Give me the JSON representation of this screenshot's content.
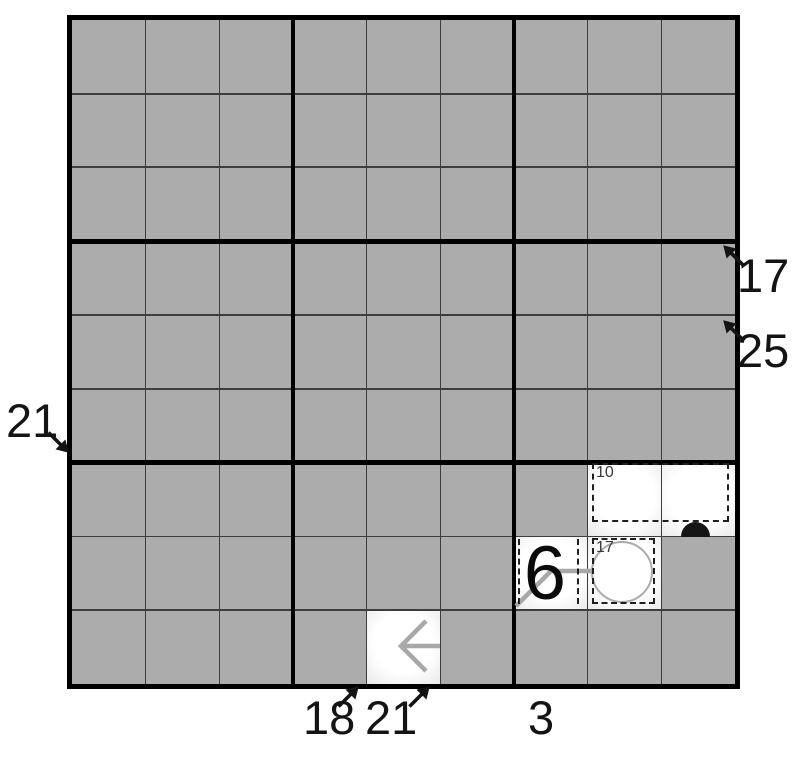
{
  "puzzle": {
    "kind": "sudoku-variant-grid",
    "grid": {
      "rows": 9,
      "cols": 9
    },
    "colors": {
      "cell_gray": "#acacac",
      "thin_line": "#3d3d3d",
      "box_line": "#000000",
      "clue_text": "#141414",
      "cage_dash": "#1f1f1f",
      "shape_gray": "#a8a8a8",
      "dot_black": "#151515"
    },
    "clues": [
      {
        "value": "17",
        "side": "right",
        "arrow": "up-left"
      },
      {
        "value": "25",
        "side": "right",
        "arrow": "up-left"
      },
      {
        "value": "21",
        "side": "left",
        "arrow": "down-right"
      },
      {
        "value": "18",
        "side": "bottom",
        "arrow": "up-right"
      },
      {
        "value": "21",
        "side": "bottom",
        "arrow": "up-right"
      },
      {
        "value": "3",
        "side": "bottom",
        "arrow": "none"
      }
    ],
    "cages": [
      {
        "label": "10",
        "cells": "r7c8-r7c9"
      },
      {
        "label": "17",
        "cells": "r8c8"
      },
      {
        "label": "",
        "cells": "r8c7"
      }
    ],
    "givens": [
      {
        "value": "6",
        "cell": "r8c7"
      }
    ],
    "shapes": [
      {
        "name": "white-circle",
        "cell": "r8c8"
      },
      {
        "name": "black-dot",
        "edge": "r7c9-r8c9"
      },
      {
        "name": "gray-arrow-line",
        "cells": "r8c8-r8c7-corner"
      },
      {
        "name": "left-arrow-glyph",
        "cell": "r9c5"
      }
    ]
  }
}
